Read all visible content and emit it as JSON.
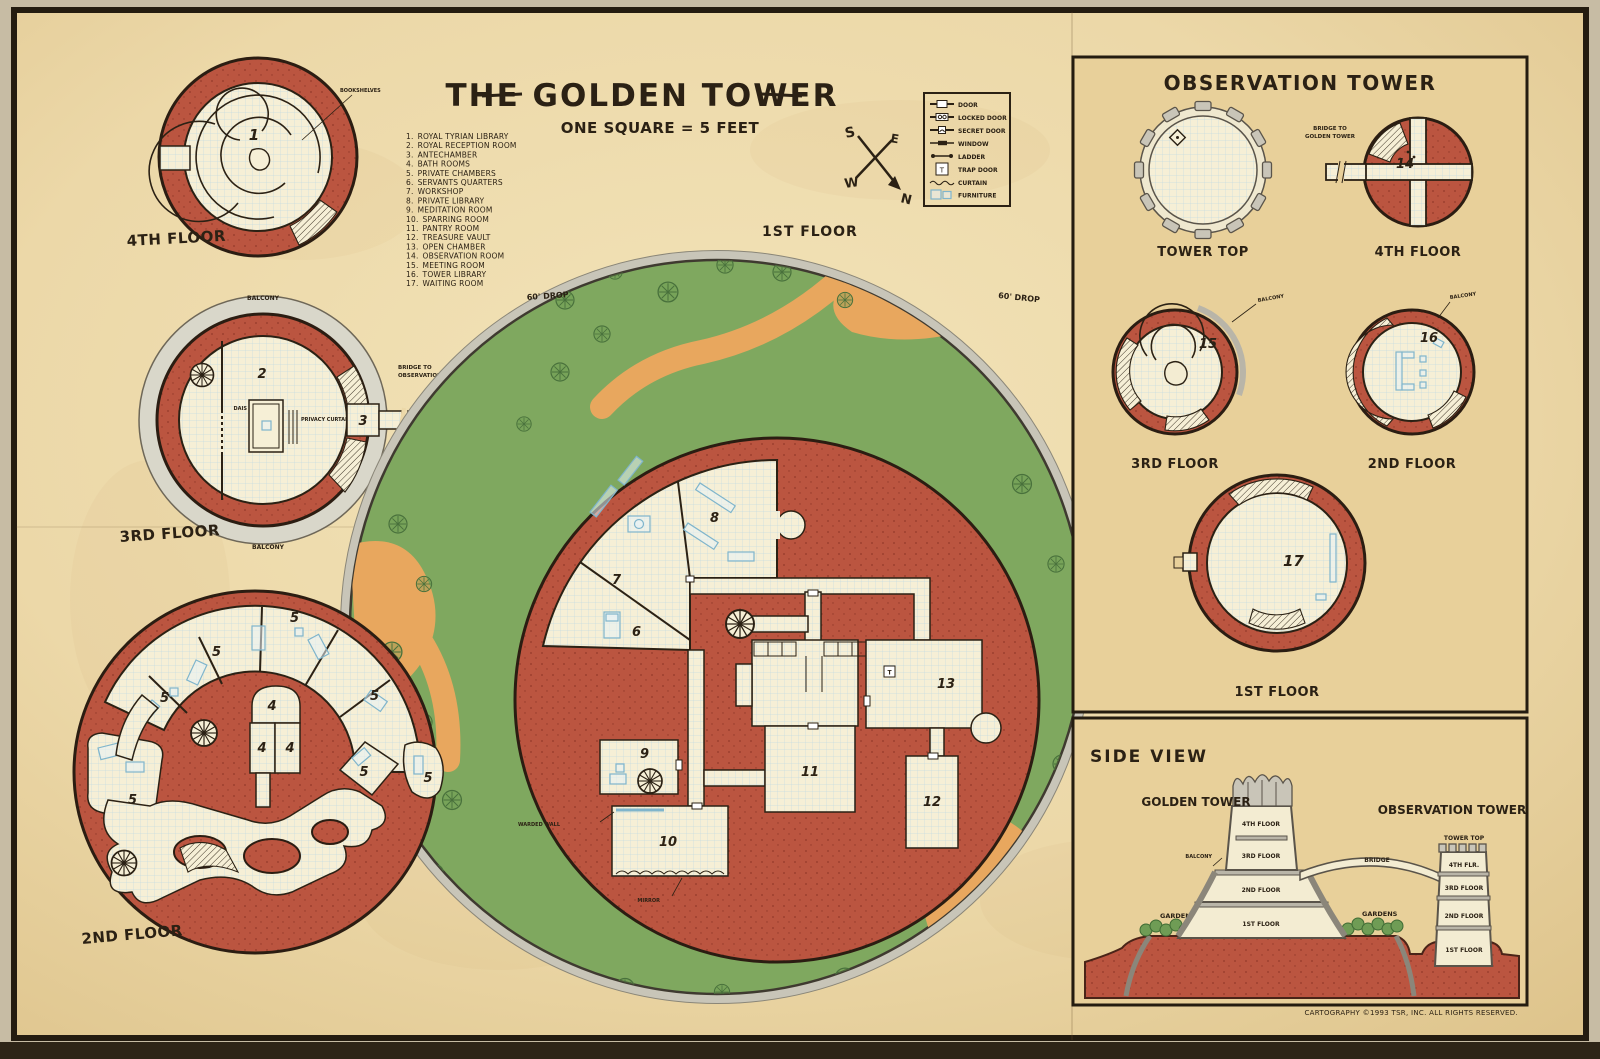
{
  "title": {
    "text": "THE GOLDEN TOWER",
    "scale": "ONE SQUARE = 5 FEET"
  },
  "compass": {
    "n": "N",
    "s": "S",
    "e": "E",
    "w": "W"
  },
  "legend": {
    "items": [
      "DOOR",
      "LOCKED DOOR",
      "SECRET DOOR",
      "WINDOW",
      "LADDER",
      "TRAP DOOR",
      "CURTAIN",
      "FURNITURE"
    ],
    "trap_symbol": "T"
  },
  "rooms": [
    {
      "num": "1.",
      "name": "ROYAL TYRIAN LIBRARY",
      "mark": "1"
    },
    {
      "num": "2.",
      "name": "ROYAL RECEPTION ROOM",
      "mark": "2"
    },
    {
      "num": "3.",
      "name": "ANTECHAMBER",
      "mark": "3"
    },
    {
      "num": "4.",
      "name": "BATH ROOMS",
      "mark": "4"
    },
    {
      "num": "5.",
      "name": "PRIVATE CHAMBERS",
      "mark": "5"
    },
    {
      "num": "6.",
      "name": "SERVANTS QUARTERS",
      "mark": "6"
    },
    {
      "num": "7.",
      "name": "WORKSHOP",
      "mark": "7"
    },
    {
      "num": "8.",
      "name": "PRIVATE LIBRARY",
      "mark": "8"
    },
    {
      "num": "9.",
      "name": "MEDITATION ROOM",
      "mark": "9"
    },
    {
      "num": "10.",
      "name": "SPARRING ROOM",
      "mark": "10"
    },
    {
      "num": "11.",
      "name": "PANTRY ROOM",
      "mark": "11"
    },
    {
      "num": "12.",
      "name": "TREASURE VAULT",
      "mark": "12"
    },
    {
      "num": "13.",
      "name": "OPEN CHAMBER",
      "mark": "13"
    },
    {
      "num": "14.",
      "name": "OBSERVATION ROOM",
      "mark": "14"
    },
    {
      "num": "15.",
      "name": "MEETING ROOM",
      "mark": "15"
    },
    {
      "num": "16.",
      "name": "TOWER LIBRARY",
      "mark": "16"
    },
    {
      "num": "17.",
      "name": "WAITING ROOM",
      "mark": "17"
    }
  ],
  "golden_tower": {
    "floor1_label": "1ST FLOOR",
    "floor2_label": "2ND FLOOR",
    "floor3_label": "3RD FLOOR",
    "floor4_label": "4TH FLOOR",
    "balcony": "BALCONY",
    "bookshelves": "BOOKSHELVES",
    "dais": "DAIS",
    "privacy_curtains": "PRIVACY CURTAINS",
    "bridge_note_l1": "BRIDGE TO",
    "bridge_note_l2": "OBSERVATION TOWER",
    "drop_note": "60' DROP",
    "warded_wall": "WARDED WALL",
    "mirror": "MIRROR"
  },
  "observation_tower": {
    "title": "OBSERVATION TOWER",
    "tower_top_label": "TOWER TOP",
    "floor4_label": "4TH FLOOR",
    "floor3_label": "3RD FLOOR",
    "floor2_label": "2ND FLOOR",
    "floor1_label": "1ST FLOOR",
    "balcony": "BALCONY",
    "bridge_note_l1": "BRIDGE TO",
    "bridge_note_l2": "GOLDEN TOWER"
  },
  "side_view": {
    "title": "SIDE VIEW",
    "golden_tower_label": "GOLDEN TOWER",
    "observation_tower_label": "OBSERVATION TOWER",
    "tower_top": "TOWER TOP",
    "balcony": "BALCONY",
    "bridge": "BRIDGE",
    "gardens": "GARDENS",
    "gt_floors": [
      "4TH FLOOR",
      "3RD FLOOR",
      "2ND FLOOR",
      "1ST FLOOR"
    ],
    "ot_floors": [
      "4TH FLR.",
      "3RD FLOOR",
      "2ND FLOOR",
      "1ST FLOOR"
    ]
  },
  "credit": "CARTOGRAPHY ©1993 TSR, INC. ALL RIGHTS RESERVED.",
  "colors": {
    "parchment": "#ecd8a8",
    "panel": "#e8d09a",
    "red": "#bb5540",
    "green": "#7fa85f",
    "orange": "#e8a75e",
    "room": "#f6efd6",
    "stone": "#d9d7ca",
    "ink": "#2b2114",
    "furniture": "#7fb5cc"
  }
}
